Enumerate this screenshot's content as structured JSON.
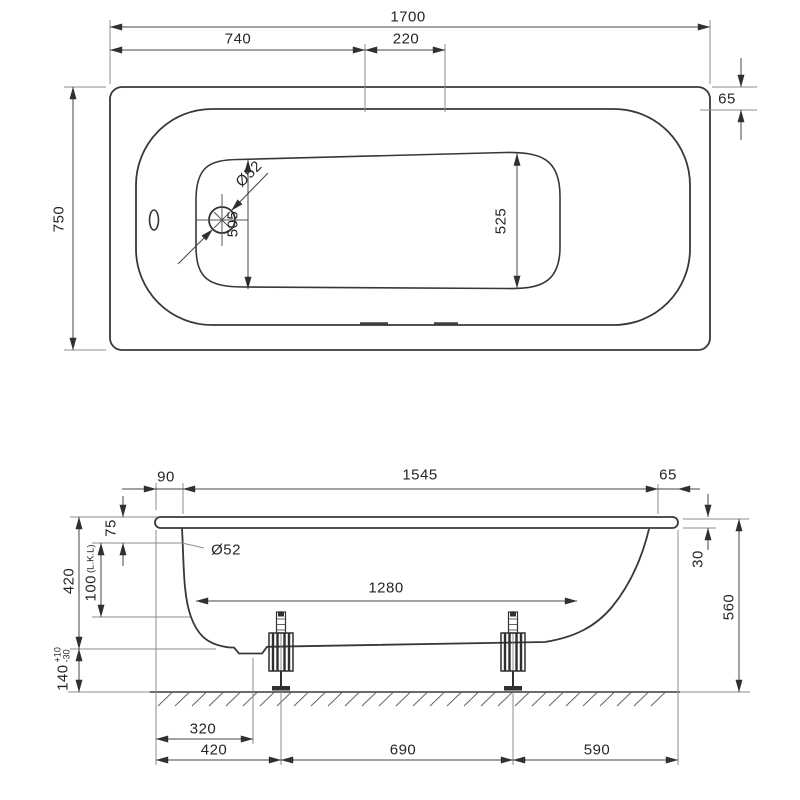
{
  "colors": {
    "background": "#ffffff",
    "line": "#383838",
    "dimension": "#8c8c8c",
    "text": "#262626"
  },
  "plan_view": {
    "overall_length": "1700",
    "section_left": "740",
    "section_center": "220",
    "rim_width": "65",
    "overall_width": "750",
    "floor_width_drain_end": "505",
    "floor_width_far_end": "525",
    "drain_diameter": "Ø52"
  },
  "side_view": {
    "rim_overhang": "90",
    "inner_length": "1545",
    "rim_width": "65",
    "rim_to_drain_center": "75",
    "drain_diameter": "Ø52",
    "body_depth": "420",
    "water_depth_value": "100",
    "water_depth_suffix": "(L.K.L)",
    "clearance_value": "140",
    "clearance_tol_plus": "+10",
    "clearance_tol_minus": "-30",
    "floor_length": "1280",
    "rim_drop": "30",
    "overall_height": "560",
    "drain_offset": "320",
    "front_foot_offset": "420",
    "foot_spacing": "690",
    "rear_foot_offset": "590"
  }
}
